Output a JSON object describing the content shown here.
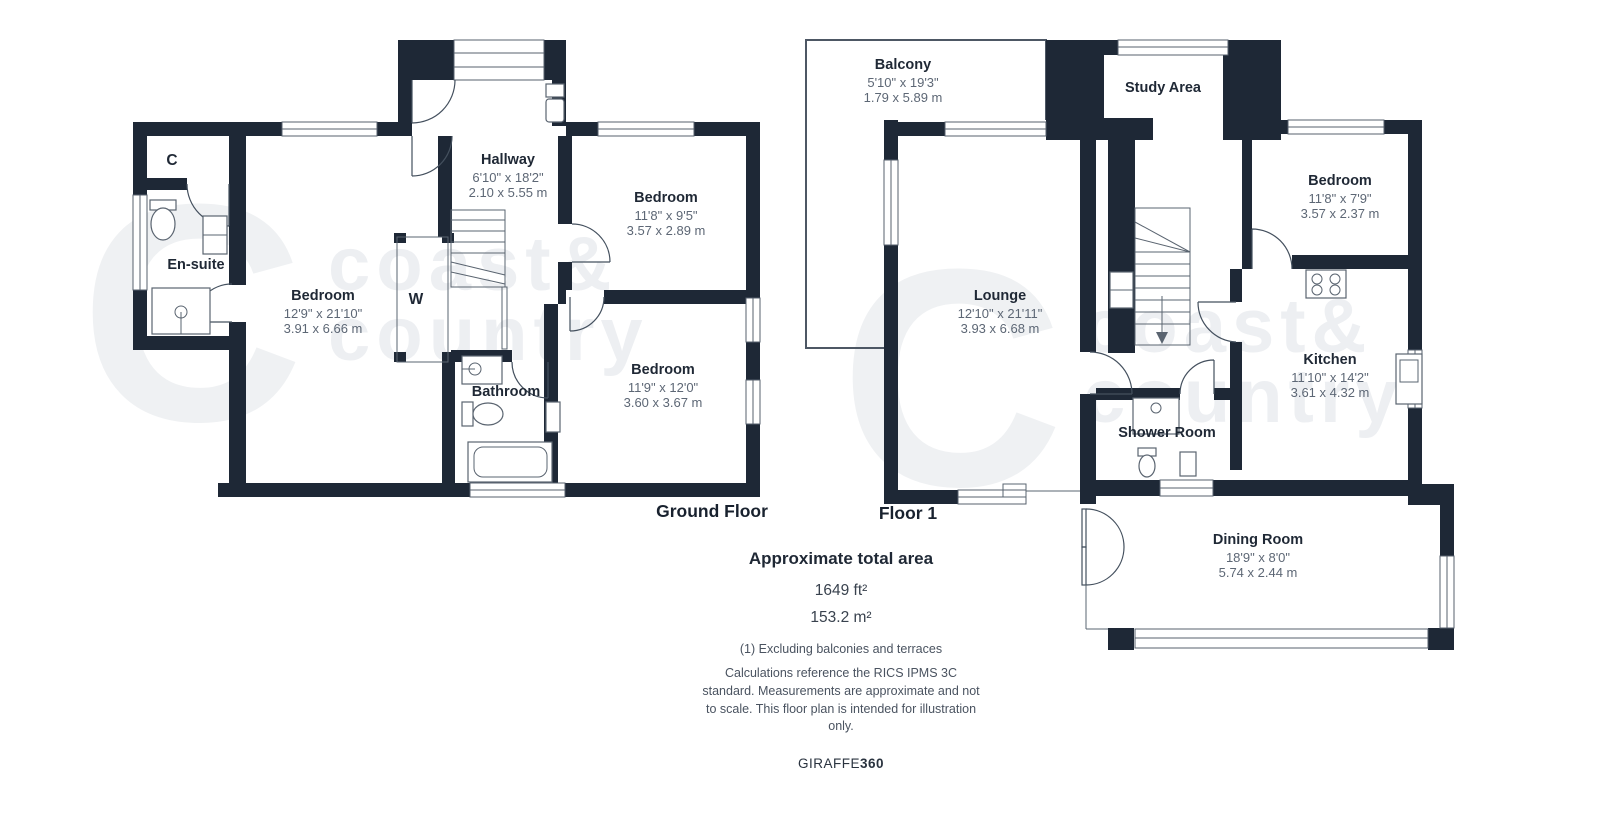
{
  "watermark": {
    "big_letter": "C",
    "line1": "coast&",
    "line2": "country"
  },
  "colors": {
    "wall": "#1e2836",
    "room_text": "#1f2835",
    "dim_text": "#5d6775",
    "watermark": "#eff1f3"
  },
  "ground_floor": {
    "label": "Ground Floor",
    "rooms": {
      "cupboard": {
        "name": "C"
      },
      "ensuite": {
        "name": "En-suite"
      },
      "hallway": {
        "name": "Hallway",
        "imperial": "6'10\" x 18'2\"",
        "metric": "2.10 x 5.55 m"
      },
      "bedroom_front": {
        "name": "Bedroom",
        "imperial": "12'9\" x 21'10\"",
        "metric": "3.91 x 6.66 m"
      },
      "bedroom_top": {
        "name": "Bedroom",
        "imperial": "11'8\" x 9'5\"",
        "metric": "3.57 x 2.89 m"
      },
      "bedroom_rear": {
        "name": "Bedroom",
        "imperial": "11'9\" x 12'0\"",
        "metric": "3.60 x 3.67 m"
      },
      "wardrobe": {
        "name": "W"
      },
      "bathroom": {
        "name": "Bathroom"
      }
    }
  },
  "floor_1": {
    "label": "Floor 1",
    "rooms": {
      "balcony": {
        "name": "Balcony",
        "imperial": "5'10\" x 19'3\"",
        "metric": "1.79 x 5.89 m"
      },
      "study": {
        "name": "Study Area"
      },
      "bedroom": {
        "name": "Bedroom",
        "imperial": "11'8\" x 7'9\"",
        "metric": "3.57 x 2.37 m"
      },
      "lounge": {
        "name": "Lounge",
        "imperial": "12'10\" x 21'11\"",
        "metric": "3.93 x 6.68 m"
      },
      "kitchen": {
        "name": "Kitchen",
        "imperial": "11'10\" x 14'2\"",
        "metric": "3.61 x 4.32 m"
      },
      "shower_room": {
        "name": "Shower Room"
      },
      "dining_room": {
        "name": "Dining Room",
        "imperial": "18'9\" x 8'0\"",
        "metric": "5.74 x 2.44 m"
      }
    }
  },
  "summary": {
    "title": "Approximate total area",
    "area_imperial": "1649 ft²",
    "area_metric": "153.2 m²",
    "exclusion_note": "(1) Excluding balconies and terraces",
    "disclaimer": "Calculations reference the RICS IPMS 3C standard. Measurements are approximate and not to scale. This floor plan is intended for illustration only.",
    "brand": {
      "name": "GIRAFFE",
      "suffix": "360"
    }
  }
}
